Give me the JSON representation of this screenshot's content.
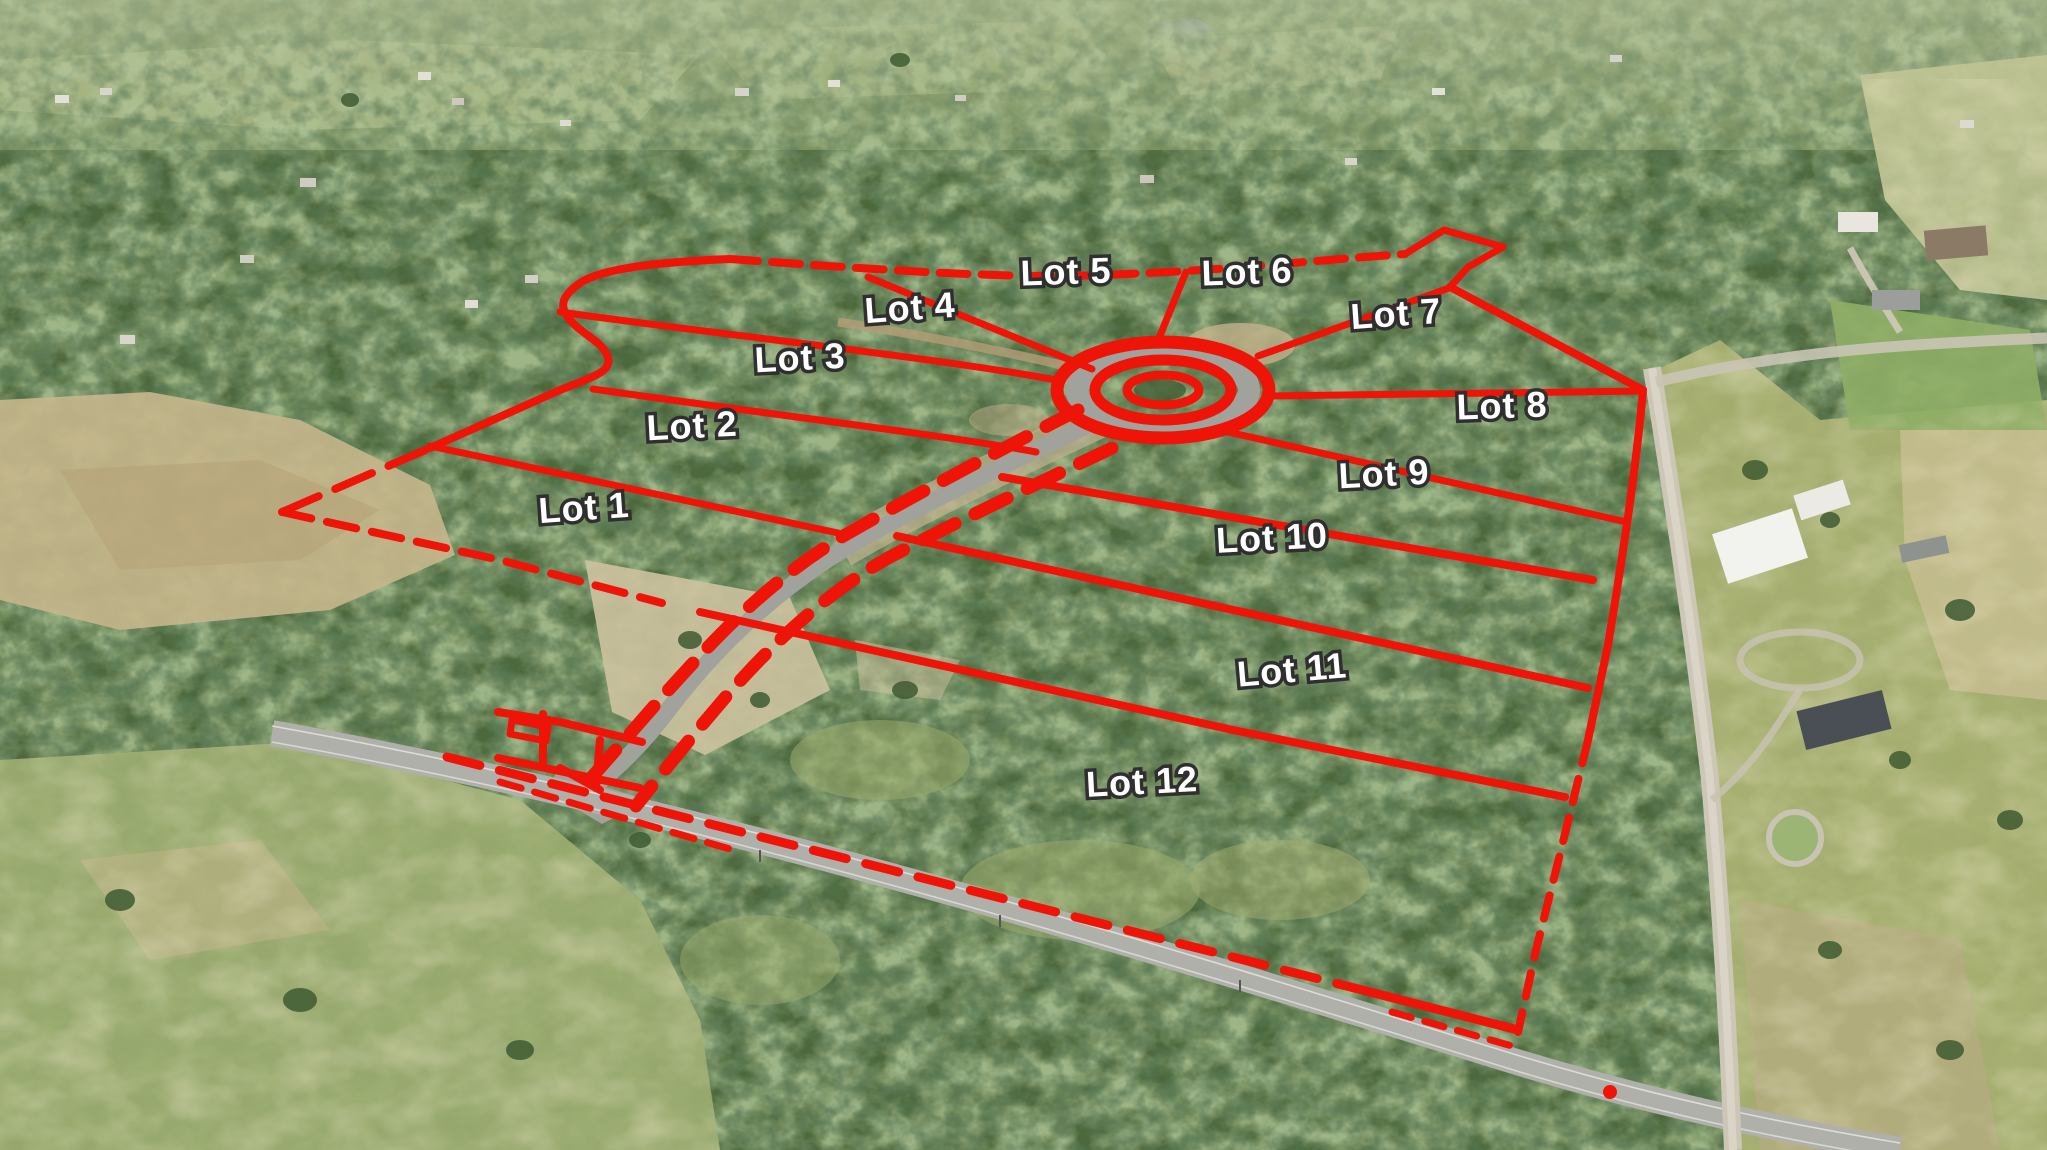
{
  "scene": {
    "description": "Aerial drone photo of wooded acreage subdivided into 12 lots, outlined with a red plat overlay: outer property boundary, lot dividers radiating from a central cul-de-sac, an entry road corridor marked with red dashes, and a highway frontage boundary."
  },
  "colors": {
    "accent-red": "#ee1408",
    "label-fill": "#ffffff",
    "label-outline": "#2f2f2f"
  },
  "lots": [
    {
      "label": "Lot 1"
    },
    {
      "label": "Lot 2"
    },
    {
      "label": "Lot 3"
    },
    {
      "label": "Lot 4"
    },
    {
      "label": "Lot 5"
    },
    {
      "label": "Lot 6"
    },
    {
      "label": "Lot 7"
    },
    {
      "label": "Lot 8"
    },
    {
      "label": "Lot 9"
    },
    {
      "label": "Lot 10"
    },
    {
      "label": "Lot 11"
    },
    {
      "label": "Lot 12"
    }
  ]
}
